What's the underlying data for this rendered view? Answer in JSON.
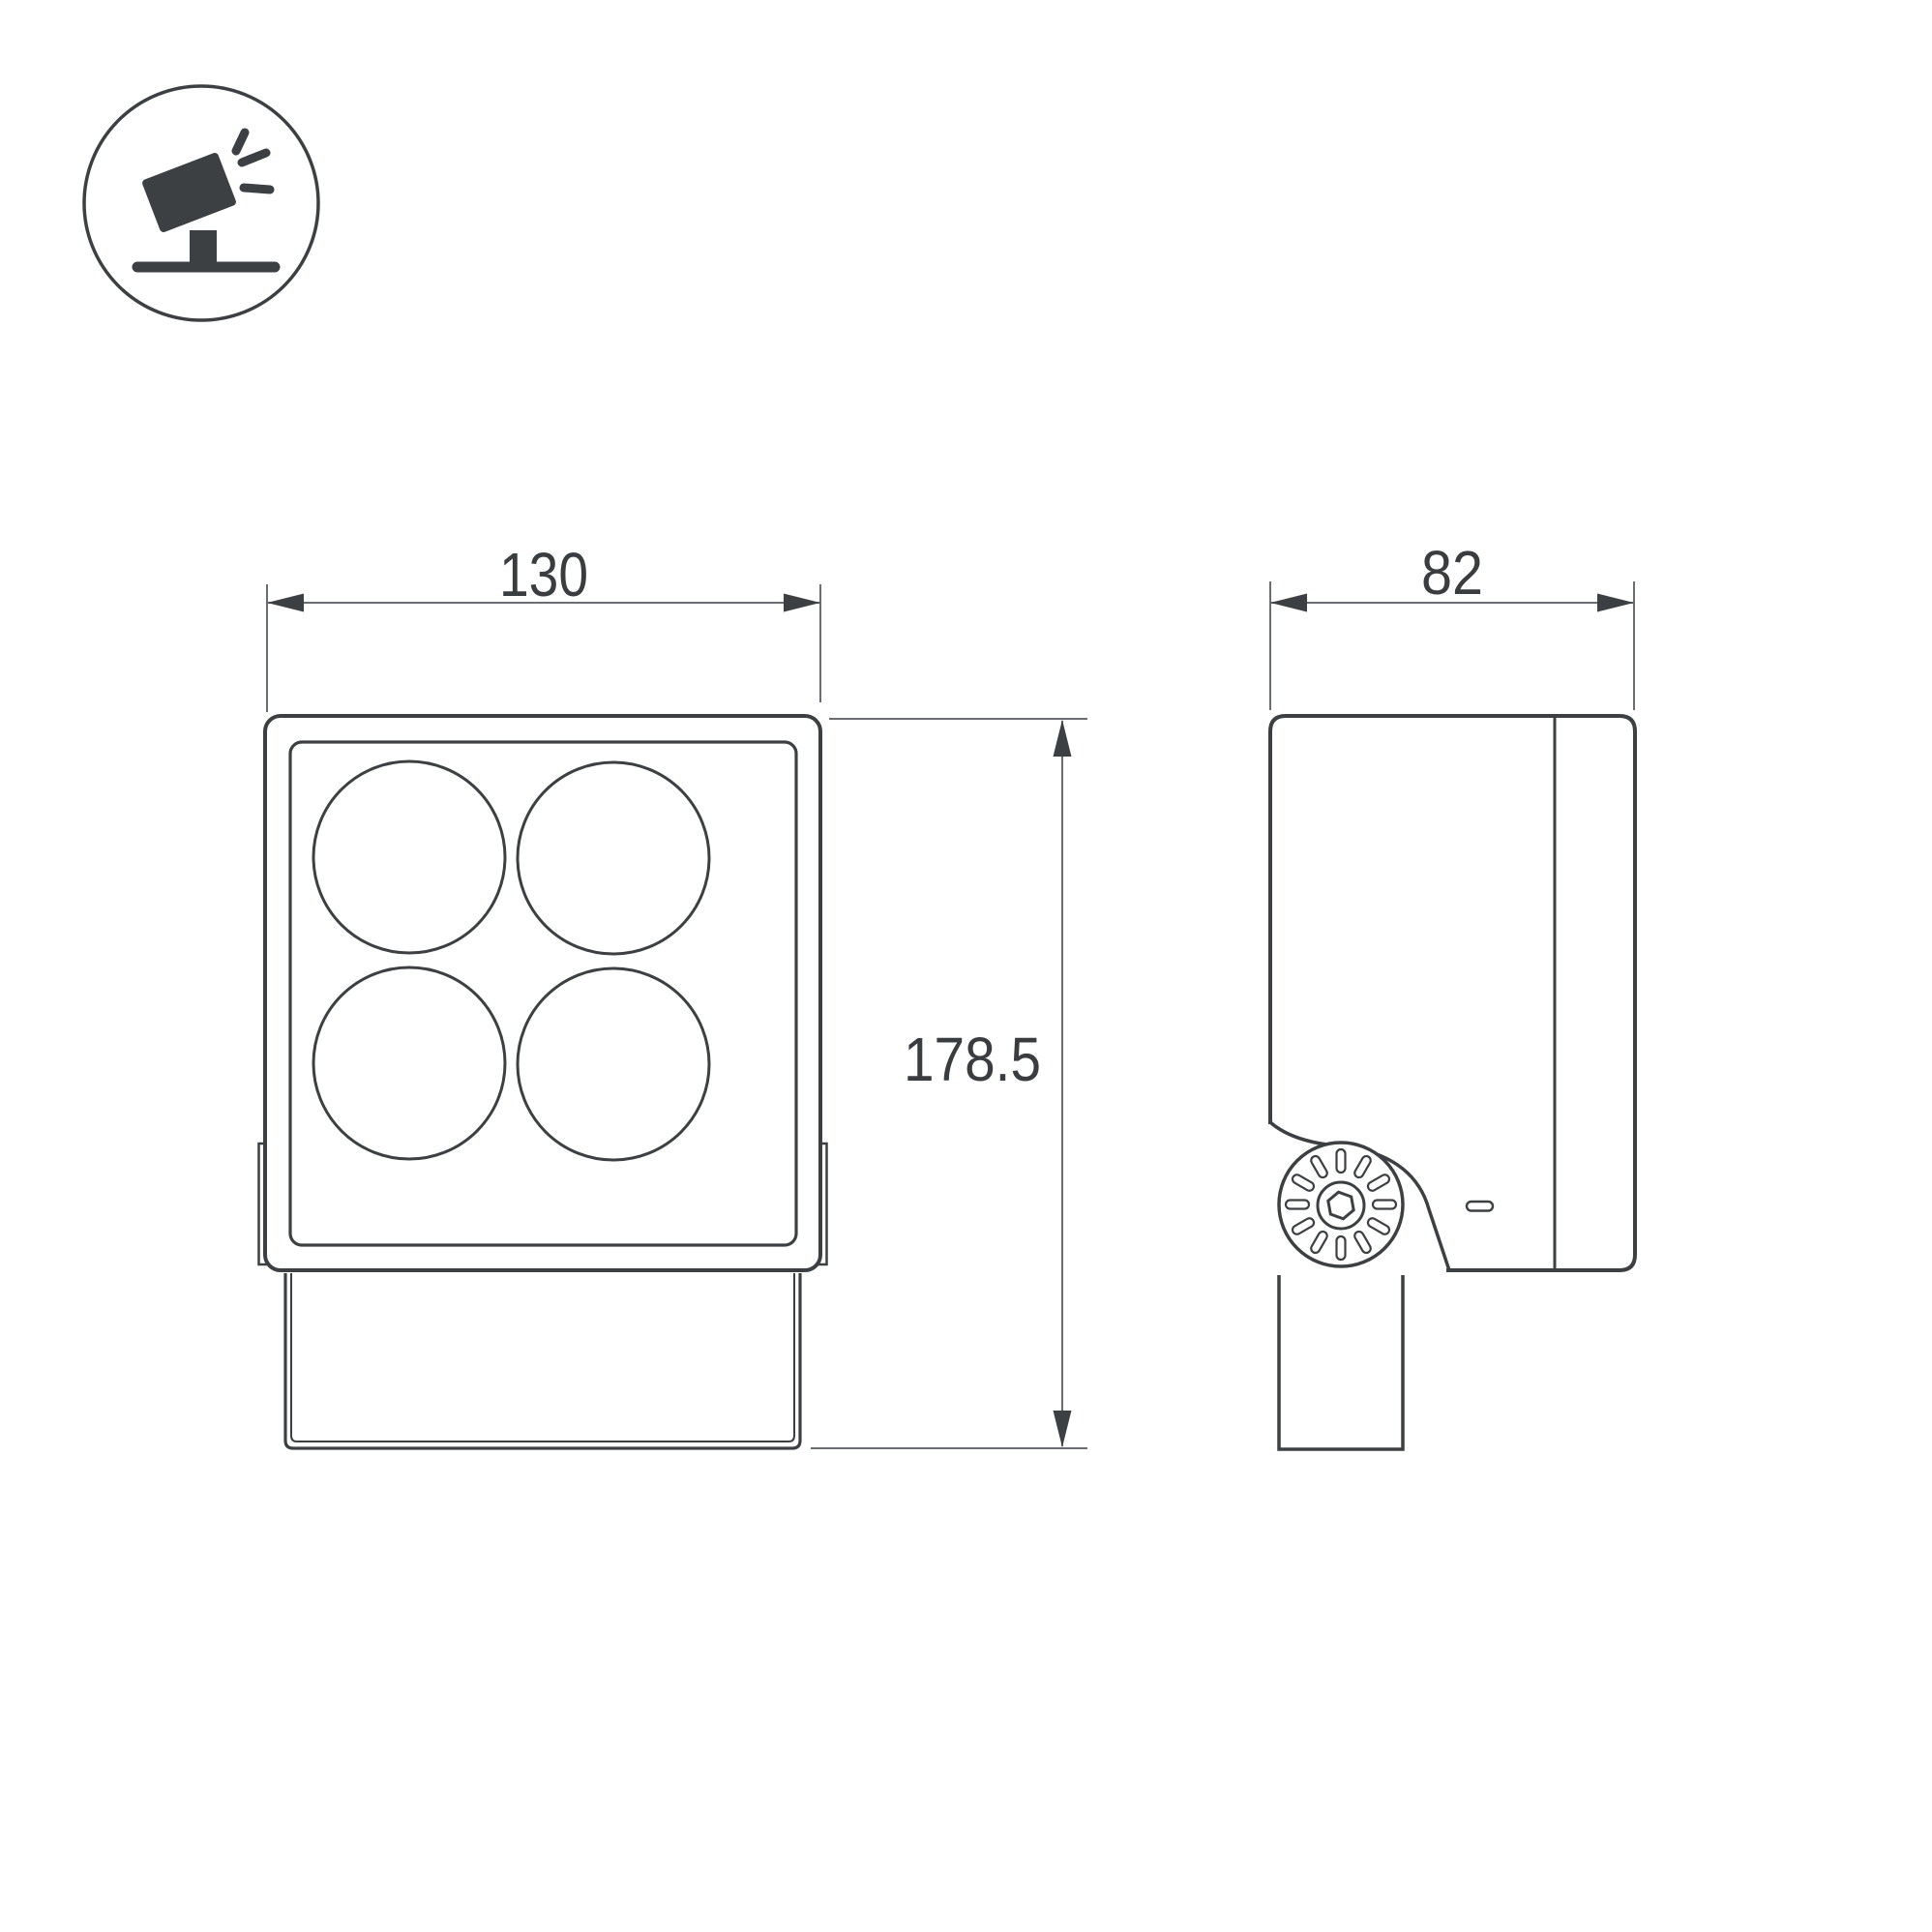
{
  "drawing": {
    "type_icon": {
      "name": "tilted-floodlight-on-stand-icon"
    },
    "views": {
      "front": {
        "name": "front-view",
        "lens_count": 4
      },
      "side": {
        "name": "side-view"
      }
    },
    "dims": {
      "width": "130",
      "depth": "82",
      "height": "178.5"
    },
    "colors": {
      "outline": "#3d4043",
      "dim_line": "#6a6e72",
      "text": "#3a3d40",
      "background": "#ffffff"
    }
  }
}
